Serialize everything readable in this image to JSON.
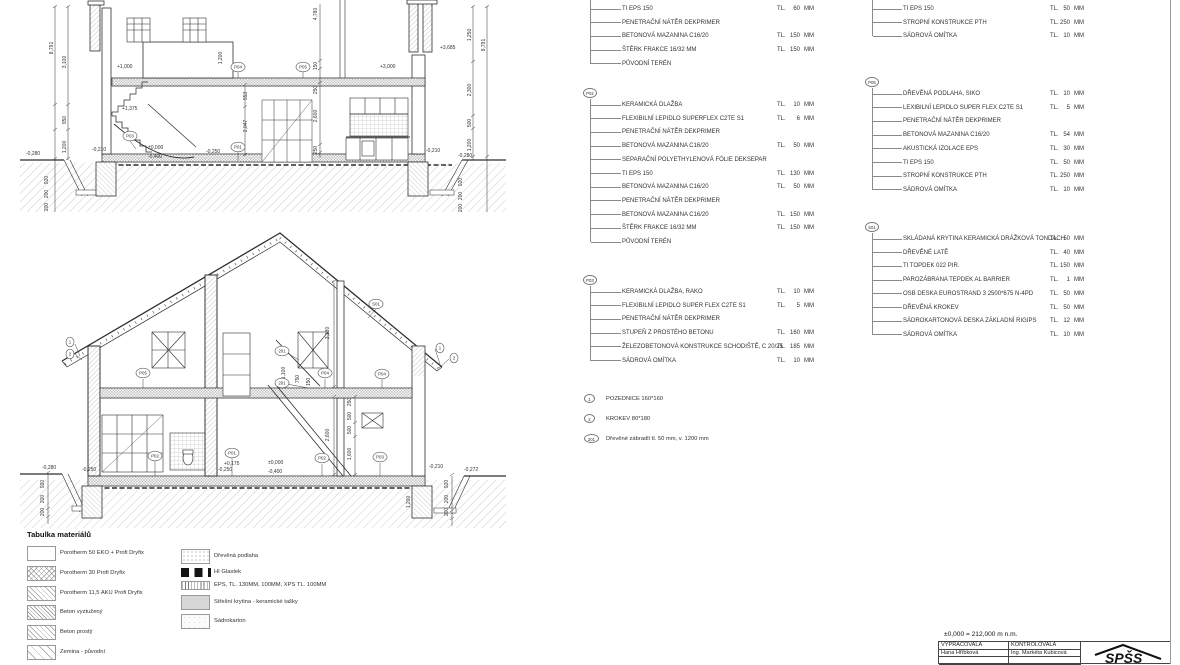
{
  "legend": {
    "columns": [
      {
        "id": "col1",
        "blocks": [
          {
            "label": "",
            "y": 9,
            "rows": [
              {
                "n": "TI EPS 150",
                "tl": "TL.",
                "v": "60",
                "u": "MM"
              },
              {
                "n": "PENETRAČNÍ NÁTĚR DEKPRIMER"
              },
              {
                "n": "BETONOVÁ MAZANINA C16/20",
                "tl": "TL.",
                "v": "150",
                "u": "MM"
              },
              {
                "n": "ŠTĚRK FRAKCE 16/32 MM",
                "tl": "TL.",
                "v": "150",
                "u": "MM"
              },
              {
                "n": "PŮVODNÍ TERÉN"
              }
            ]
          },
          {
            "label": "P02",
            "y": 105,
            "rows": [
              {
                "n": "KERAMICKÁ DLAŽBA",
                "tl": "TL.",
                "v": "10",
                "u": "MM"
              },
              {
                "n": "FLEXIBILNÍ LEPIDLO SUPERFLEX C2TE S1",
                "tl": "TL.",
                "v": "6",
                "u": "MM"
              },
              {
                "n": "PENETRAČNÍ NÁTĚR DEKPRIMER"
              },
              {
                "n": "BETONOVÁ MAZANINA  C16/20",
                "tl": "TL.",
                "v": "50",
                "u": "MM"
              },
              {
                "n": "SEPARAČNÍ POLYETHYLENOVÁ FÓLIE DEKSEPAR"
              },
              {
                "n": "TI EPS 150",
                "tl": "TL.",
                "v": "130",
                "u": "MM"
              },
              {
                "n": "BETONOVÁ MAZANINA C16/20",
                "tl": "TL.",
                "v": "50",
                "u": "MM"
              },
              {
                "n": "PENETRAČNÍ NÁTĚR DEKPRIMER"
              },
              {
                "n": "BETONOVÁ MAZANINA C16/20",
                "tl": "TL.",
                "v": "150",
                "u": "MM"
              },
              {
                "n": "ŠTĚRK FRAKCE 16/32 MM",
                "tl": "TL.",
                "v": "150",
                "u": "MM"
              },
              {
                "n": "PŮVODNÍ TERÉN"
              }
            ]
          },
          {
            "label": "P03",
            "y": 292,
            "rows": [
              {
                "n": "KERAMICKÁ DLAŽBA, RAKO",
                "tl": "TL.",
                "v": "10",
                "u": "MM"
              },
              {
                "n": "FLEXIBILNÍ LEPIDLO SUPER FLEX C2TE S1",
                "tl": "TL.",
                "v": "5",
                "u": "MM"
              },
              {
                "n": "PENETRAČNÍ NÁTĚR DEKPRIMER"
              },
              {
                "n": "STUPEŇ Z PROSTÉHO BETONU",
                "tl": "TL.",
                "v": "160",
                "u": "MM"
              },
              {
                "n": "ŽELEZOBETONOVÁ KONSTRUKCE SCHODIŠTĚ, C 20/25",
                "tl": "TL.",
                "v": "185",
                "u": "MM"
              },
              {
                "n": "SÁDROVÁ OMÍTKA",
                "tl": "TL.",
                "v": "10",
                "u": "MM"
              }
            ]
          }
        ]
      },
      {
        "id": "col2",
        "blocks": [
          {
            "label": "",
            "y": 9,
            "rows": [
              {
                "n": "TI EPS 150",
                "tl": "TL.",
                "v": "50",
                "u": "MM"
              },
              {
                "n": "STROPNÍ KONSTRUKCE PTH",
                "tl": "TL.",
                "v": "250",
                "u": "MM"
              },
              {
                "n": "SÁDROVÁ OMÍTKA",
                "tl": "TL.",
                "v": "10",
                "u": "MM"
              }
            ]
          },
          {
            "label": "P05",
            "y": 94,
            "rows": [
              {
                "n": "DŘEVĚNÁ PODLAHA, SIKO",
                "tl": "TL.",
                "v": "10",
                "u": "MM"
              },
              {
                "n": "LEXIBILNÍ LEPIDLO SUPER FLEX C2TE S1",
                "tl": "TL.",
                "v": "5",
                "u": "MM"
              },
              {
                "n": "PENETRAČNÍ NÁTĚR DEKPRIMER"
              },
              {
                "n": "BETONOVÁ MAZANINA C16/20",
                "tl": "TL.",
                "v": "54",
                "u": "MM"
              },
              {
                "n": "AKUSTICKÁ IZOLACE EPS",
                "tl": "TL.",
                "v": "30",
                "u": "MM"
              },
              {
                "n": "TI EPS 150",
                "tl": "TL.",
                "v": "50",
                "u": "MM"
              },
              {
                "n": "STROPNÍ KONSTRUKCE PTH",
                "tl": "TL.",
                "v": "250",
                "u": "MM"
              },
              {
                "n": "SÁDROVÁ OMÍTKA",
                "tl": "TL.",
                "v": "10",
                "u": "MM"
              }
            ]
          },
          {
            "label": "S01",
            "y": 239,
            "rows": [
              {
                "n": "SKLÁDANÁ KRYTINA KERAMICKÁ DRÁŽKOVÁ TONDACH",
                "tl": "TL.",
                "v": "50",
                "u": "MM"
              },
              {
                "n": "DŘEVĚNÉ LATĚ",
                "tl": "TL.",
                "v": "40",
                "u": "MM"
              },
              {
                "n": "TI TOPDEK 022 PIR.",
                "tl": "TL.",
                "v": "150",
                "u": "MM"
              },
              {
                "n": "PAROZÁBRANA TEPDEK AL BARRIER",
                "tl": "TL.",
                "v": "1",
                "u": "MM"
              },
              {
                "n": "OSB DESKA EUROSTRAND 3 2500*675 N-4PD",
                "tl": "TL.",
                "v": "50",
                "u": "MM"
              },
              {
                "n": "DŘEVĚNÁ KROKEV",
                "tl": "TL.",
                "v": "50",
                "u": "MM"
              },
              {
                "n": "SÁDROKARTONOVÁ DESKA ZÁKLADNÍ RIGIPS",
                "tl": "TL.",
                "v": "12",
                "u": "MM"
              },
              {
                "n": "SÁDROVÁ OMÍTKA",
                "tl": "TL.",
                "v": "10",
                "u": "MM"
              }
            ]
          }
        ]
      }
    ]
  },
  "notes": [
    {
      "id": "1",
      "text": "POZEDNICE 160*160"
    },
    {
      "id": "2",
      "text": "KROKEV 80*180"
    },
    {
      "id": "201",
      "text": "Dřevěné zábradlí tl. 50 mm, v. 1200 mm"
    }
  ],
  "materials": {
    "title": "Tabulka materiálů",
    "left": [
      {
        "label": "Porotherm 50 EKO + Profi Dryfix",
        "swatch": "empty"
      },
      {
        "label": "Porotherm 30 Profi Dryfix",
        "swatch": "cross"
      },
      {
        "label": "Porotherm 11,5 AKU Profi Dryfix",
        "swatch": "diag"
      },
      {
        "label": "Beton vyztužený",
        "swatch": "diag-dense"
      },
      {
        "label": "Beton prostý",
        "swatch": "diag"
      },
      {
        "label": "Zemina - původní",
        "swatch": "diag-wide"
      }
    ],
    "right": [
      {
        "label": "Dřevěná podlaha",
        "swatch": "stipple"
      },
      {
        "label": "HI Glastek",
        "swatch": "glastek"
      },
      {
        "label": "EPS, TL.  130MM, 100MM, XPS TL. 100MM",
        "swatch": "eps"
      },
      {
        "label": "Střešní krytina - keramické tašky",
        "swatch": "gray"
      },
      {
        "label": "Sádrokarton",
        "swatch": "plaster"
      }
    ]
  },
  "titleblock": {
    "datum": "±0,000 = 212,000 m n.m.",
    "made_by_label": "VYPRACOVALA",
    "checked_by_label": "KONTROLOVALA",
    "made_by": "Hana Hříbková",
    "checked_by": "Ing. Markéta Kubicová",
    "logo": "SPŠS"
  },
  "drawings": {
    "top": {
      "labels": [
        {
          "t": "8,791",
          "x": 35,
          "y": 48,
          "r": -90
        },
        {
          "t": "3,100",
          "x": 48,
          "y": 62,
          "r": -90
        },
        {
          "t": "950",
          "x": 48,
          "y": 120,
          "r": -90
        },
        {
          "t": "1,200",
          "x": 48,
          "y": 147,
          "r": -90
        },
        {
          "t": "920",
          "x": 30,
          "y": 180,
          "r": -90
        },
        {
          "t": "200",
          "x": 30,
          "y": 194,
          "r": -90
        },
        {
          "t": "200",
          "x": 30,
          "y": 207,
          "r": -90
        },
        {
          "t": "4,780",
          "x": 299,
          "y": 14,
          "r": -90
        },
        {
          "t": "150",
          "x": 299,
          "y": 66,
          "r": -90
        },
        {
          "t": "250",
          "x": 299,
          "y": 90,
          "r": -90
        },
        {
          "t": "2,600",
          "x": 299,
          "y": 116,
          "r": -90
        },
        {
          "t": "250",
          "x": 299,
          "y": 150,
          "r": -90
        },
        {
          "t": "1,200",
          "x": 204,
          "y": 58,
          "r": -90
        },
        {
          "t": "553",
          "x": 229,
          "y": 96,
          "r": -90
        },
        {
          "t": "2,047",
          "x": 229,
          "y": 126,
          "r": -90
        },
        {
          "t": "1,250",
          "x": 453,
          "y": 35,
          "r": -90
        },
        {
          "t": "2,300",
          "x": 453,
          "y": 90,
          "r": -90
        },
        {
          "t": "500",
          "x": 453,
          "y": 123,
          "r": -90
        },
        {
          "t": "1,200",
          "x": 453,
          "y": 145,
          "r": -90
        },
        {
          "t": "8,791",
          "x": 467,
          "y": 45,
          "r": -90
        },
        {
          "t": "920",
          "x": 444,
          "y": 182,
          "r": -90
        },
        {
          "t": "200",
          "x": 444,
          "y": 196,
          "r": -90
        },
        {
          "t": "200",
          "x": 444,
          "y": 208,
          "r": -90
        },
        {
          "t": "-0,280",
          "x": 8,
          "y": 155
        },
        {
          "t": "-0,210",
          "x": 74,
          "y": 151
        },
        {
          "t": "+1,375",
          "x": 104,
          "y": 110
        },
        {
          "t": "+1,000",
          "x": 99,
          "y": 68
        },
        {
          "t": "±0,000",
          "x": 130,
          "y": 149
        },
        {
          "t": "-0,400",
          "x": 130,
          "y": 158
        },
        {
          "t": "-0,250",
          "x": 188,
          "y": 153
        },
        {
          "t": "+3,000",
          "x": 362,
          "y": 68
        },
        {
          "t": "+3,685",
          "x": 422,
          "y": 49
        },
        {
          "t": "-0,210",
          "x": 408,
          "y": 152
        },
        {
          "t": "-0,280",
          "x": 440,
          "y": 157
        }
      ],
      "callouts": [
        {
          "t": "P03",
          "x": 112,
          "y": 136
        },
        {
          "t": "P01",
          "x": 220,
          "y": 147
        },
        {
          "t": "P04",
          "x": 220,
          "y": 67
        },
        {
          "t": "P05",
          "x": 285,
          "y": 67
        }
      ]
    },
    "bottom": {
      "labels": [
        {
          "t": "3,130",
          "x": 311,
          "y": 105,
          "r": -90
        },
        {
          "t": "1,100",
          "x": 267,
          "y": 145,
          "r": -90
        },
        {
          "t": "750",
          "x": 281,
          "y": 151,
          "r": -90
        },
        {
          "t": "150",
          "x": 292,
          "y": 154,
          "r": -90
        },
        {
          "t": "2,600",
          "x": 311,
          "y": 207,
          "r": -90
        },
        {
          "t": "250",
          "x": 333,
          "y": 174,
          "r": -90
        },
        {
          "t": "500",
          "x": 333,
          "y": 188,
          "r": -90
        },
        {
          "t": "500",
          "x": 333,
          "y": 202,
          "r": -90
        },
        {
          "t": "1,600",
          "x": 333,
          "y": 226,
          "r": -90
        },
        {
          "t": "1,200",
          "x": 392,
          "y": 274,
          "r": -90
        },
        {
          "t": "920",
          "x": 26,
          "y": 256,
          "r": -90
        },
        {
          "t": "200",
          "x": 26,
          "y": 271,
          "r": -90
        },
        {
          "t": "200",
          "x": 26,
          "y": 284,
          "r": -90
        },
        {
          "t": "920",
          "x": 430,
          "y": 256,
          "r": -90
        },
        {
          "t": "200",
          "x": 430,
          "y": 271,
          "r": -90
        },
        {
          "t": "200",
          "x": 430,
          "y": 284,
          "r": -90
        },
        {
          "t": "-0,280",
          "x": 24,
          "y": 241
        },
        {
          "t": "-0,250",
          "x": 64,
          "y": 243
        },
        {
          "t": "-0,250",
          "x": 200,
          "y": 243
        },
        {
          "t": "+0,175",
          "x": 206,
          "y": 237
        },
        {
          "t": "±0,000",
          "x": 250,
          "y": 236
        },
        {
          "t": "-0,400",
          "x": 250,
          "y": 245
        },
        {
          "t": "-0,210",
          "x": 411,
          "y": 240
        },
        {
          "t": "-0,272",
          "x": 446,
          "y": 243
        }
      ],
      "callouts": [
        {
          "t": "1",
          "x": 52,
          "y": 114
        },
        {
          "t": "2",
          "x": 52,
          "y": 126
        },
        {
          "t": "201",
          "x": 264,
          "y": 123
        },
        {
          "t": "201",
          "x": 264,
          "y": 155
        },
        {
          "t": "S01",
          "x": 358,
          "y": 76
        },
        {
          "t": "1",
          "x": 422,
          "y": 120
        },
        {
          "t": "2",
          "x": 436,
          "y": 130
        },
        {
          "t": "P05",
          "x": 125,
          "y": 145
        },
        {
          "t": "P04",
          "x": 307,
          "y": 145
        },
        {
          "t": "P04",
          "x": 364,
          "y": 146
        },
        {
          "t": "P02",
          "x": 137,
          "y": 228
        },
        {
          "t": "P01",
          "x": 214,
          "y": 225
        },
        {
          "t": "P02",
          "x": 304,
          "y": 230
        },
        {
          "t": "P03",
          "x": 362,
          "y": 229
        }
      ]
    }
  }
}
